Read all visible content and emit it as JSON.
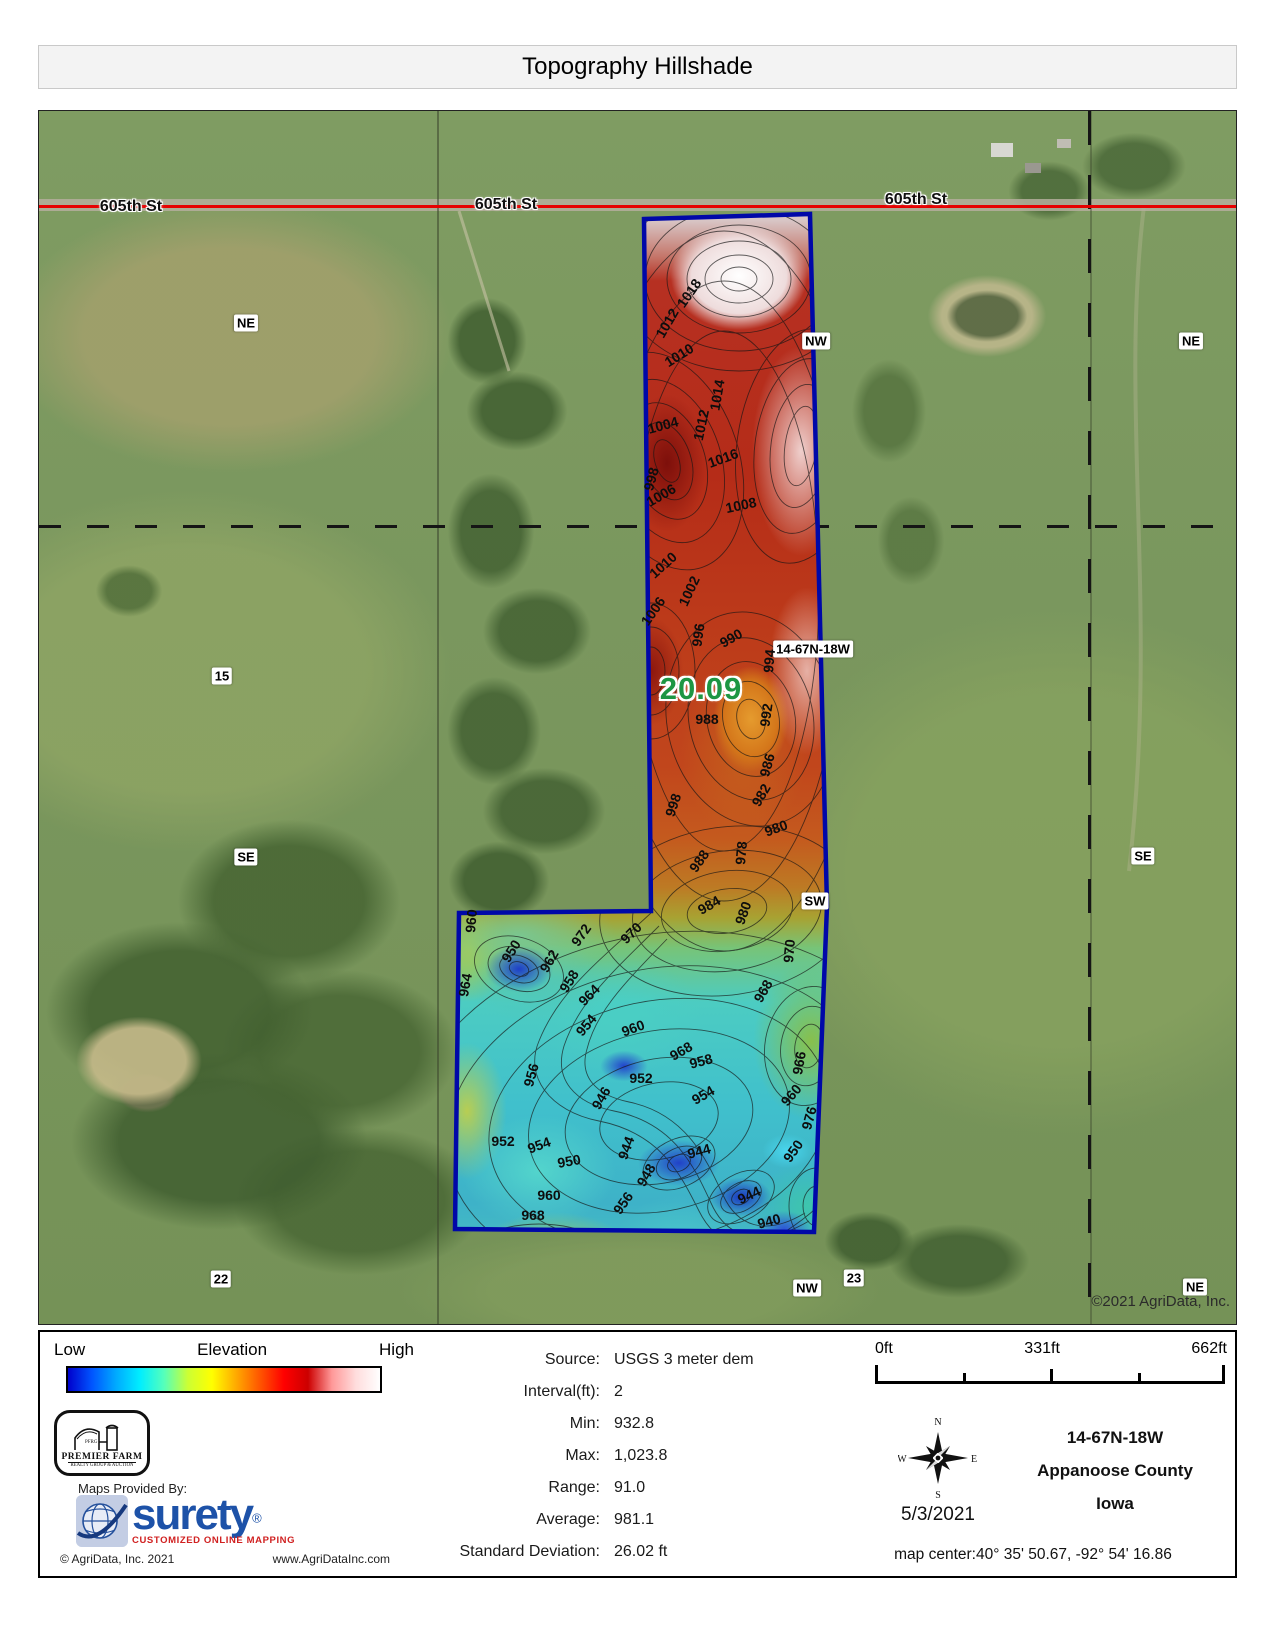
{
  "title": "Topography Hillshade",
  "map": {
    "road_name": "605th St",
    "road_labels": [
      {
        "x": 92,
        "y": 96
      },
      {
        "x": 467,
        "y": 94
      },
      {
        "x": 877,
        "y": 89
      }
    ],
    "section_labels": [
      {
        "t": "NE",
        "x": 207,
        "y": 212
      },
      {
        "t": "NW",
        "x": 777,
        "y": 230
      },
      {
        "t": "NE",
        "x": 1152,
        "y": 230
      },
      {
        "t": "15",
        "x": 183,
        "y": 565
      },
      {
        "t": "14-67N-18W",
        "x": 774,
        "y": 538
      },
      {
        "t": "SE",
        "x": 207,
        "y": 746
      },
      {
        "t": "SW",
        "x": 776,
        "y": 790
      },
      {
        "t": "SE",
        "x": 1104,
        "y": 745
      },
      {
        "t": "22",
        "x": 182,
        "y": 1168
      },
      {
        "t": "NW",
        "x": 768,
        "y": 1177
      },
      {
        "t": "23",
        "x": 815,
        "y": 1167
      },
      {
        "t": "NE",
        "x": 1156,
        "y": 1176
      }
    ],
    "area_label": {
      "text": "20.09",
      "color": "#1d9643",
      "x": 662,
      "y": 578
    },
    "copyright": "©2021 AgriData, Inc.",
    "parcel_border_color": "#0008a8",
    "road_color": "#e60000",
    "contour_labels": [
      {
        "t": "1018",
        "x": 650,
        "y": 182,
        "r": -55
      },
      {
        "t": "1012",
        "x": 628,
        "y": 212,
        "r": -60
      },
      {
        "t": "1010",
        "x": 640,
        "y": 244,
        "r": -32
      },
      {
        "t": "1014",
        "x": 678,
        "y": 284,
        "r": -80
      },
      {
        "t": "1012",
        "x": 662,
        "y": 314,
        "r": -78
      },
      {
        "t": "1004",
        "x": 624,
        "y": 314,
        "r": -15
      },
      {
        "t": "1016",
        "x": 684,
        "y": 347,
        "r": -20
      },
      {
        "t": "998",
        "x": 612,
        "y": 368,
        "r": -75
      },
      {
        "t": "1006",
        "x": 622,
        "y": 384,
        "r": -30
      },
      {
        "t": "1008",
        "x": 702,
        "y": 394,
        "r": -12
      },
      {
        "t": "1010",
        "x": 624,
        "y": 454,
        "r": -42
      },
      {
        "t": "1006",
        "x": 614,
        "y": 500,
        "r": -55
      },
      {
        "t": "1002",
        "x": 650,
        "y": 480,
        "r": -65
      },
      {
        "t": "996",
        "x": 659,
        "y": 524,
        "r": -82
      },
      {
        "t": "990",
        "x": 692,
        "y": 527,
        "r": -30
      },
      {
        "t": "994",
        "x": 730,
        "y": 550,
        "r": -85
      },
      {
        "t": "992",
        "x": 727,
        "y": 604,
        "r": -82
      },
      {
        "t": "988",
        "x": 668,
        "y": 608,
        "r": 0
      },
      {
        "t": "986",
        "x": 728,
        "y": 654,
        "r": -75
      },
      {
        "t": "982",
        "x": 722,
        "y": 684,
        "r": -60
      },
      {
        "t": "998",
        "x": 634,
        "y": 694,
        "r": -72
      },
      {
        "t": "978",
        "x": 702,
        "y": 742,
        "r": -85
      },
      {
        "t": "988",
        "x": 660,
        "y": 750,
        "r": -55
      },
      {
        "t": "980",
        "x": 737,
        "y": 717,
        "r": -20
      },
      {
        "t": "984",
        "x": 670,
        "y": 794,
        "r": -30
      },
      {
        "t": "980",
        "x": 704,
        "y": 802,
        "r": -70
      },
      {
        "t": "972",
        "x": 542,
        "y": 824,
        "r": -55
      },
      {
        "t": "960",
        "x": 432,
        "y": 810,
        "r": -85
      },
      {
        "t": "950",
        "x": 472,
        "y": 840,
        "r": -58
      },
      {
        "t": "962",
        "x": 510,
        "y": 850,
        "r": -60
      },
      {
        "t": "958",
        "x": 530,
        "y": 870,
        "r": -58
      },
      {
        "t": "964",
        "x": 550,
        "y": 884,
        "r": -45
      },
      {
        "t": "964",
        "x": 426,
        "y": 874,
        "r": -80
      },
      {
        "t": "954",
        "x": 547,
        "y": 914,
        "r": -50
      },
      {
        "t": "960",
        "x": 594,
        "y": 917,
        "r": -20
      },
      {
        "t": "968",
        "x": 642,
        "y": 940,
        "r": -30
      },
      {
        "t": "958",
        "x": 662,
        "y": 950,
        "r": -15
      },
      {
        "t": "970",
        "x": 750,
        "y": 840,
        "r": -85
      },
      {
        "t": "968",
        "x": 724,
        "y": 880,
        "r": -60
      },
      {
        "t": "966",
        "x": 760,
        "y": 952,
        "r": -80
      },
      {
        "t": "976",
        "x": 770,
        "y": 1007,
        "r": -75
      },
      {
        "t": "952",
        "x": 602,
        "y": 967,
        "r": 0
      },
      {
        "t": "954",
        "x": 664,
        "y": 984,
        "r": -30
      },
      {
        "t": "956",
        "x": 492,
        "y": 964,
        "r": -75
      },
      {
        "t": "946",
        "x": 562,
        "y": 987,
        "r": -60
      },
      {
        "t": "944",
        "x": 587,
        "y": 1037,
        "r": -70
      },
      {
        "t": "952",
        "x": 464,
        "y": 1030,
        "r": 0
      },
      {
        "t": "954",
        "x": 500,
        "y": 1034,
        "r": -20
      },
      {
        "t": "950",
        "x": 530,
        "y": 1050,
        "r": -10
      },
      {
        "t": "960",
        "x": 510,
        "y": 1084,
        "r": 0
      },
      {
        "t": "968",
        "x": 494,
        "y": 1104,
        "r": 0
      },
      {
        "t": "956",
        "x": 584,
        "y": 1092,
        "r": -55
      },
      {
        "t": "948",
        "x": 607,
        "y": 1064,
        "r": -60
      },
      {
        "t": "944",
        "x": 660,
        "y": 1040,
        "r": -15
      },
      {
        "t": "944",
        "x": 710,
        "y": 1084,
        "r": -25
      },
      {
        "t": "940",
        "x": 730,
        "y": 1110,
        "r": -15
      },
      {
        "t": "950",
        "x": 754,
        "y": 1040,
        "r": -55
      },
      {
        "t": "960",
        "x": 752,
        "y": 984,
        "r": -50
      },
      {
        "t": "970",
        "x": 592,
        "y": 822,
        "r": -45
      }
    ]
  },
  "legend": {
    "low": "Low",
    "elevation": "Elevation",
    "high": "High",
    "gradient_colors": [
      "#0000cc",
      "#0055ff",
      "#00aaff",
      "#00eeff",
      "#55ffbb",
      "#ccff33",
      "#ffff00",
      "#ffaa00",
      "#ff5500",
      "#ff0000",
      "#cc0000",
      "#ff9999",
      "#ffdddd",
      "#ffffff"
    ],
    "stats": [
      {
        "label": "Source:",
        "value": "USGS 3 meter dem"
      },
      {
        "label": "Interval(ft):",
        "value": "2"
      },
      {
        "label": "Min:",
        "value": "932.8"
      },
      {
        "label": "Max:",
        "value": "1,023.8"
      },
      {
        "label": "Range:",
        "value": "91.0"
      },
      {
        "label": "Average:",
        "value": "981.1"
      },
      {
        "label": "Standard Deviation:",
        "value": "26.02 ft"
      }
    ],
    "scale_ticks": [
      "0ft",
      "331ft",
      "662ft"
    ],
    "compass": {
      "n": "N",
      "s": "S",
      "e": "E",
      "w": "W"
    },
    "date": "5/3/2021",
    "location": {
      "tract": "14-67N-18W",
      "county": "Appanoose County",
      "state": "Iowa"
    },
    "map_center": "map center:40° 35' 50.67,  -92° 54' 16.86",
    "premier_farm": {
      "abbr": "PFRG",
      "name": "PREMIER FARM",
      "sub": "REALTY GROUP & AUCTION"
    },
    "provider": {
      "label": "Maps Provided By:",
      "brand": "surety",
      "reg": "®",
      "tagline": "CUSTOMIZED ONLINE MAPPING",
      "copyright": "© AgriData, Inc. 2021",
      "url": "www.AgriDataInc.com"
    }
  }
}
